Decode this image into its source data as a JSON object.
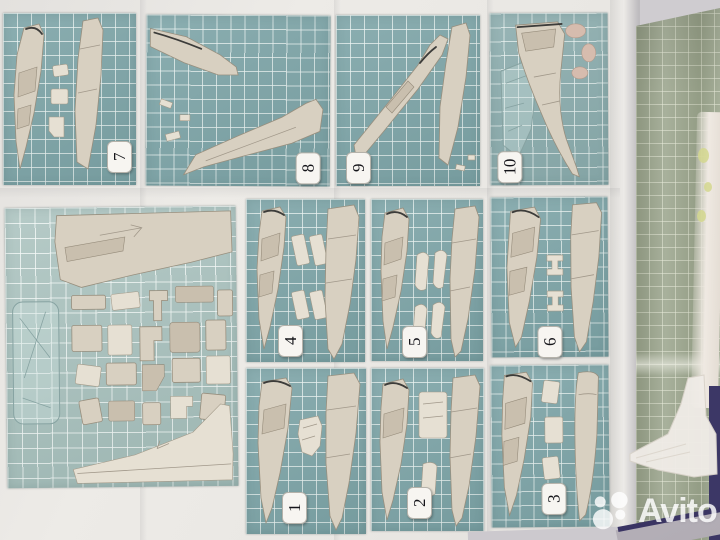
{
  "image_type": "photograph",
  "subject": "aircraft plastic model kit assembly instruction sheet lying on a table, numbered step panels printed on cutting-mat style grids",
  "watermark": {
    "brand": "Avito",
    "color": "#ffffff"
  },
  "sheet": {
    "panels": [
      {
        "id": "step-7",
        "number": "7",
        "content": "two fuselage halves with three small inserts"
      },
      {
        "id": "step-8",
        "number": "8",
        "content": "fuselage subassembly and large wing piece placed diagonally"
      },
      {
        "id": "step-9",
        "number": "9",
        "content": "fuselage with fin and separate swept wing half"
      },
      {
        "id": "step-10",
        "number": "10",
        "content": "fuselage with nose cone, clear canopy outline and pink resin parts"
      },
      {
        "id": "parts-layout",
        "number": "",
        "content": "full parts layout: large wing, clear sprue and many small components"
      },
      {
        "id": "step-4",
        "number": "4",
        "content": "fuselage half, four rectangular inserts, fuselage shell"
      },
      {
        "id": "step-5",
        "number": "5",
        "content": "fuselage half, four fin-shaped parts, fuselage shell"
      },
      {
        "id": "step-6",
        "number": "6",
        "content": "two fuselage halves with two bracket parts"
      },
      {
        "id": "step-1",
        "number": "1",
        "content": "two fuselage halves with cockpit tub part"
      },
      {
        "id": "step-2",
        "number": "2",
        "content": "fuselage half, large block part, small insert, fuselage shell"
      },
      {
        "id": "step-3",
        "number": "3",
        "content": "fuselage half, three small parts, curved wing blade"
      }
    ]
  },
  "adjacent_page": {
    "content": "second instruction page with white aircraft tail artwork on sage grid"
  },
  "colors": {
    "panel_grid_teal": "#7ea5a8",
    "parts_panel_teal": "#a6bfbb",
    "adjacent_page_sage": "#9ca68e",
    "paper_white": "#eae8e4",
    "part_beige": "#d8d0c1",
    "table_edge_navy": "#3a3463",
    "watermark_white": "#ffffff"
  }
}
